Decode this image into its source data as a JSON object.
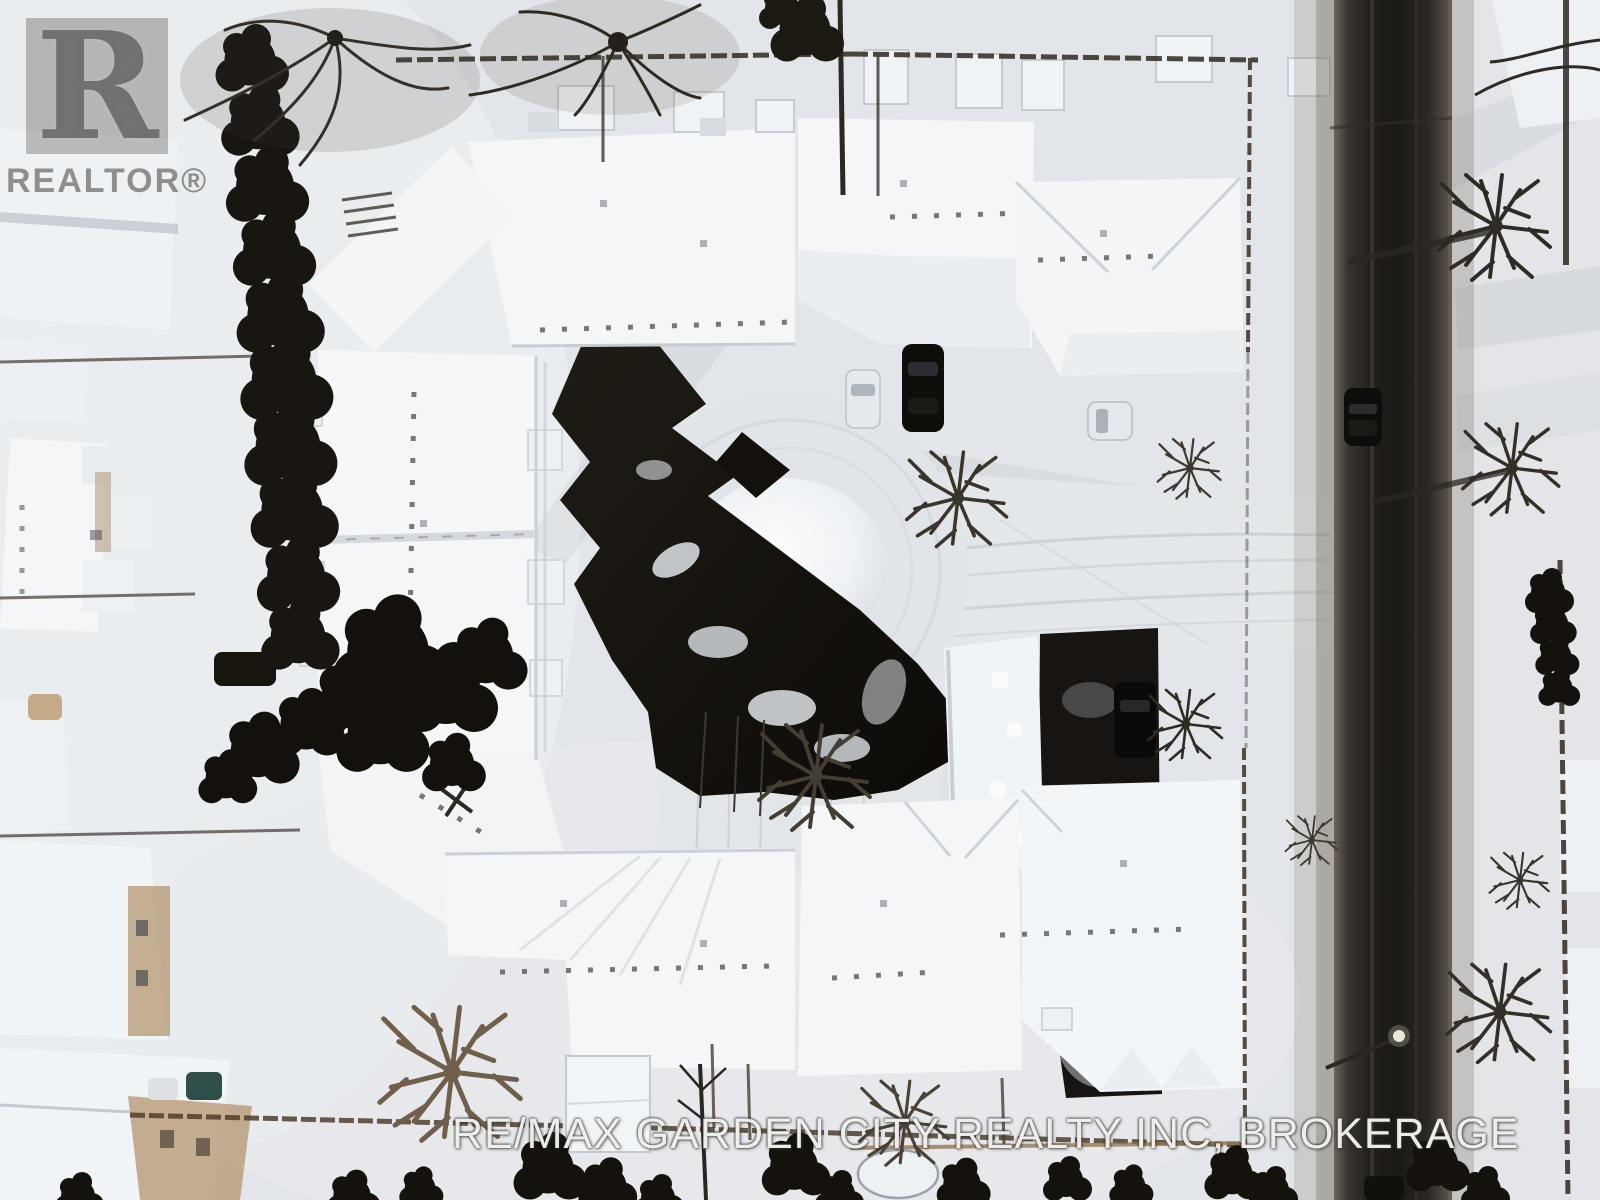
{
  "watermark": {
    "logo_letter": "R",
    "logo_text": "REALTOR®",
    "brokerage_text": "RE/MAX GARDEN CITY REALTY INC, BROKERAGE"
  },
  "scene": {
    "description": "aerial winter drone photo of snow-covered townhouse complex around a cul-de-sac beside a dark road",
    "palette": {
      "snow": "#f3f5f8",
      "snow_shadow": "#c9cfd6",
      "road_asphalt": "#1e1b18",
      "cleared_asphalt": "#15120d",
      "evergreen": "#17140f",
      "fence_wood": "#4a3c2c",
      "house_siding": "#bb9f7e"
    }
  }
}
